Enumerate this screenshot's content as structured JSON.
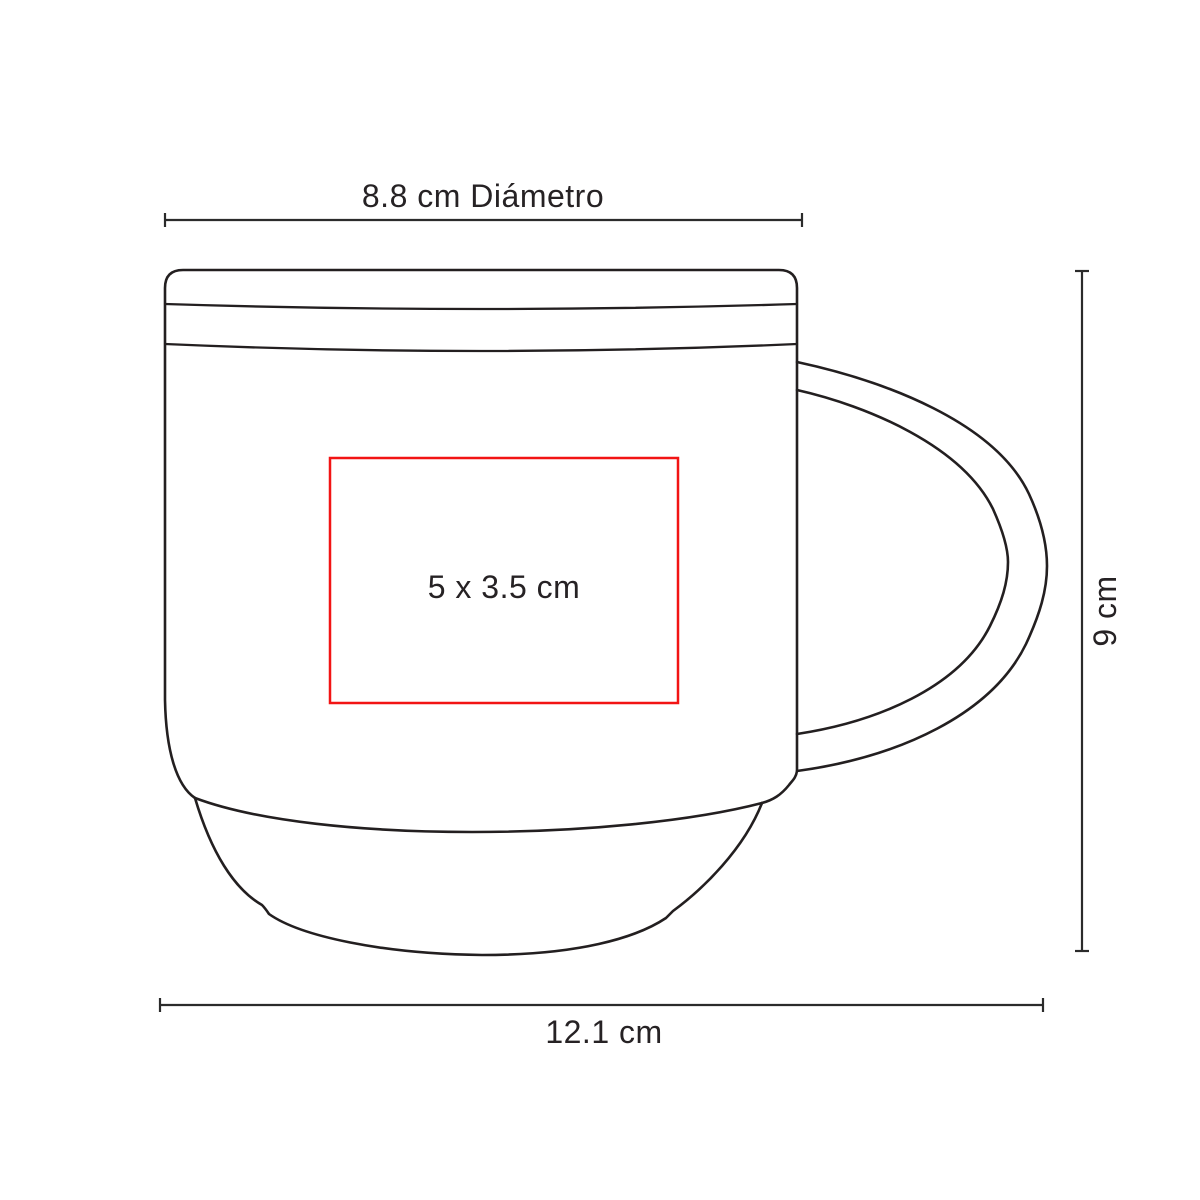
{
  "page": {
    "background": "#ffffff",
    "content_type": "product-dimension-diagram",
    "product": "stackable coffee mug outline drawing"
  },
  "colors": {
    "outline": "#231f20",
    "label_text": "#262224",
    "print_area": "#f21414",
    "background": "#ffffff"
  },
  "dimensions": {
    "top": {
      "label": "8.8 cm Diámetro"
    },
    "right": {
      "label": "9 cm"
    },
    "bottom": {
      "label": "12.1 cm"
    },
    "print_area": {
      "label": "5 x 3.5 cm"
    }
  }
}
